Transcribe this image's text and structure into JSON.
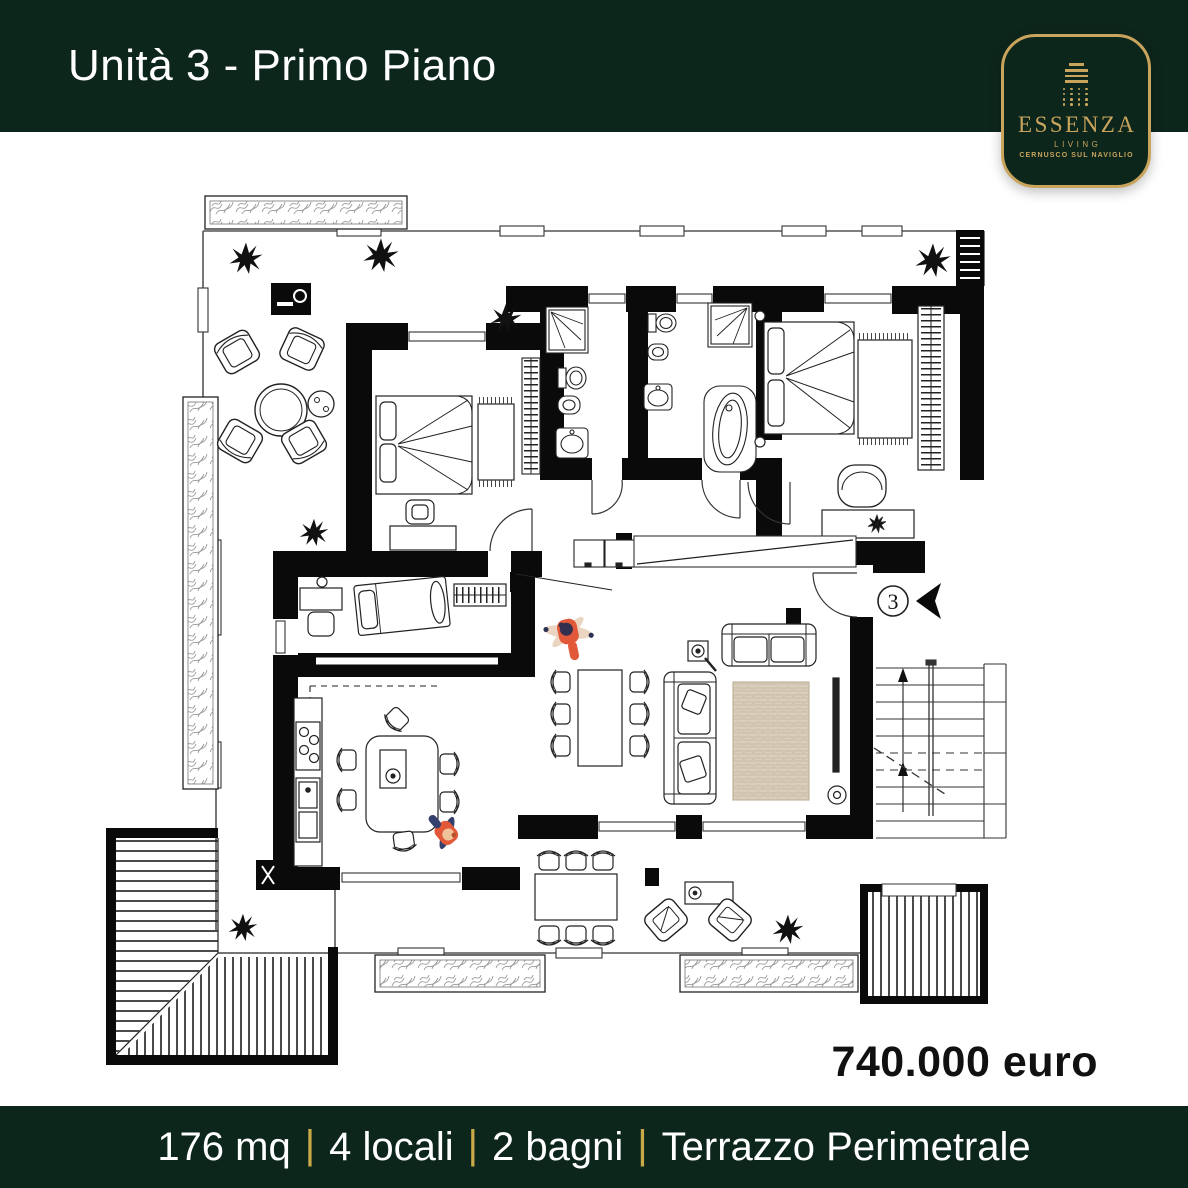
{
  "header": {
    "title": "Unità 3 - Primo Piano"
  },
  "logo": {
    "brand": "ESSENZA",
    "tagline": "LIVING",
    "location": "CERNUSCO SUL NAVIGLIO"
  },
  "plan": {
    "unit_marker": "3"
  },
  "price": {
    "label": "740.000 euro"
  },
  "footer": {
    "separator": "|",
    "items": [
      "176 mq",
      "4 locali",
      "2 bagni",
      "Terrazzo Perimetrale"
    ]
  },
  "colors": {
    "brand_green": "#0d261c",
    "brand_gold": "#c8a45c",
    "footer_separator_gold": "#c9a948",
    "price_text": "#111111",
    "rug_beige": "#d9cfbc",
    "person_orange": "#e2593a",
    "plan_line": "#1a1a1a"
  }
}
